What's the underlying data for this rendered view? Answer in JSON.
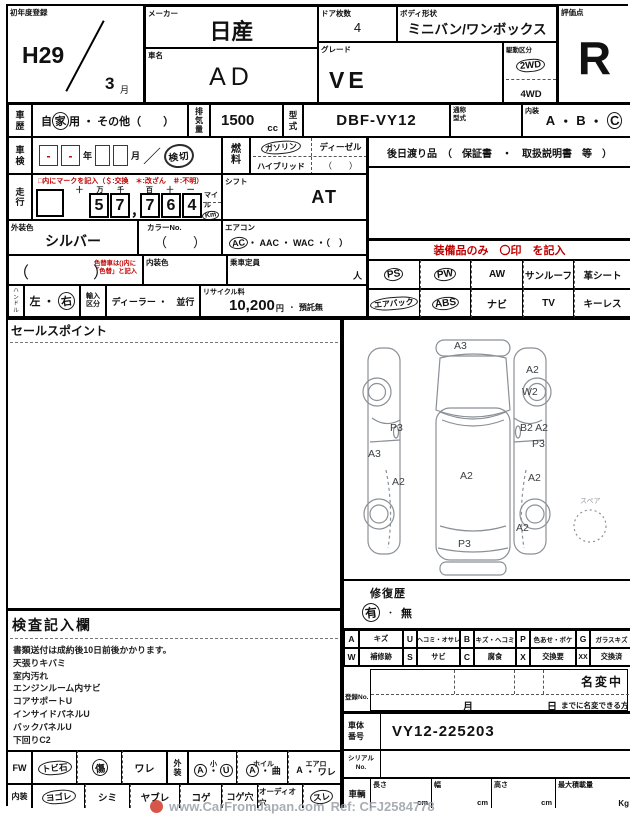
{
  "header": {
    "first_reg": {
      "label": "初年度登録",
      "year": "H29",
      "month": "3",
      "month_unit": "月"
    },
    "maker": {
      "label": "メーカー",
      "value": "日産"
    },
    "car_name": {
      "label": "車名",
      "value": "AD"
    },
    "doors": {
      "label": "ドア枚数",
      "value": "4"
    },
    "body_shape": {
      "label": "ボディ形状",
      "value": "ミニバン/ワンボックス"
    },
    "grade": {
      "label": "グレード",
      "value": "VE"
    },
    "drive": {
      "label": "駆動区分",
      "opt_2wd": "2WD",
      "opt_4wd": "4WD",
      "selected": "2WD"
    },
    "score": {
      "label": "評価点",
      "value": "R"
    }
  },
  "info": {
    "history": {
      "label": "車歴",
      "pre": "自",
      "circled": "家",
      "post": "用",
      "rest": "・ その他（　　）"
    },
    "displacement": {
      "label": "排気量",
      "value": "1500",
      "unit": "cc"
    },
    "model_code": {
      "label": "型式",
      "value": "DBF-VY12"
    },
    "alias": {
      "label": "通称型式"
    },
    "interior_grade": {
      "label": "内装",
      "a": "A",
      "sep1": "・",
      "b": "B",
      "sep2": "・",
      "c": "C",
      "selected": "C"
    },
    "inspection": {
      "label": "車検",
      "dash1": "-",
      "dash2": "-",
      "year_unit": "年",
      "month_unit": "月",
      "slash": "／",
      "stamp": "検切"
    },
    "fuel": {
      "label": "燃料",
      "gasoline": "ガソリン",
      "diesel": "ディーゼル",
      "hybrid": "ハイブリッド",
      "other": "（　　）",
      "selected": "ガソリン"
    },
    "later_goods": {
      "text": "後日渡り品　（　保証書　・　取扱説明書　等　）"
    },
    "mileage": {
      "label": "走行",
      "note": "□内にマークを記入（＄:交換　＊:改ざん　＃:不明）",
      "h1": "十",
      "h2": "万",
      "h3": "千",
      "d1": "5",
      "d2": "7",
      "comma": "，",
      "h4": "百",
      "h5": "十",
      "h6": "一",
      "d3": "7",
      "d4": "6",
      "d5": "4",
      "unit_mile": "マイル",
      "unit_km": "Km",
      "selected_unit": "Km",
      "value": "57,764"
    },
    "shift": {
      "label": "シフト",
      "value": "AT"
    },
    "ext_color": {
      "label": "外装色",
      "value": "シルバー"
    },
    "color_no": {
      "label": "カラーNo.",
      "value": "（　　）"
    },
    "aircon": {
      "label": "エアコン",
      "ac": "AC",
      "rest": "・ AAC ・ WAC ・（　）",
      "selected": "AC"
    },
    "repaint": {
      "paren": "（　　　　）",
      "note1": "色替車は()内に",
      "note2": "「色替」と記入"
    },
    "int_color": {
      "label": "内装色"
    },
    "capacity": {
      "label": "乗車定員",
      "unit": "人"
    },
    "handle": {
      "label": "ハンドル",
      "left": "左",
      "sep": "・",
      "right": "右",
      "selected": "右"
    },
    "import_type": {
      "label": "輸入区分",
      "options": "ディーラー ・　並行"
    },
    "recycle": {
      "label": "リサイクル料",
      "amount": "10,200",
      "yen": "円",
      "sep": "・",
      "status": "預託無"
    }
  },
  "equipment": {
    "note": "装備品のみ　〇印　を記入",
    "r1": [
      "PS",
      "PW",
      "AW",
      "サンルーフ",
      "革シート"
    ],
    "r2": [
      "エアバック",
      "ABS",
      "ナビ",
      "TV",
      "キーレス"
    ],
    "circled": "PS PW エアバック ABS"
  },
  "sales": {
    "title": "セールスポイント"
  },
  "notes": {
    "title": "検査記入欄",
    "lines": [
      "書類送付は成約後10日前後かかります。",
      "天張りキバミ",
      "室内汚れ",
      "エンジンルーム内サビ",
      "コアサポートU",
      "インサイドパネルU",
      "バックパネルU",
      "下回りC2"
    ]
  },
  "glass_row": {
    "label": "FW",
    "opt1": "トビ石",
    "opt2": "傷",
    "opt3": "ワレ",
    "ext_label": "外装",
    "small": {
      "label": "小",
      "a": "A",
      "dot": "・",
      "u": "U"
    },
    "wheel": {
      "label": "ホイル",
      "a": "A",
      "dot": "・",
      "bend": "曲"
    },
    "aero": {
      "label": "エアロ",
      "a": "A",
      "dot": "・",
      "crack": "ワレ"
    }
  },
  "cabin_row": {
    "label": "内装",
    "opts": [
      "ヨゴレ",
      "シミ",
      "ヤブレ",
      "コゲ",
      "コゲ穴",
      "オーディオ穴",
      "スレ"
    ],
    "circled": "ヨゴレ スレ"
  },
  "diagram": {
    "spare": "スペア",
    "labels": [
      "A3",
      "A2",
      "W2",
      "P3",
      "B2 A2",
      "P3",
      "A3",
      "A2",
      "A2",
      "A2",
      "A2",
      "P3"
    ]
  },
  "repair": {
    "label": "修復歴",
    "yes": "有",
    "sep": "・",
    "no": "無",
    "selected": "有"
  },
  "legend": {
    "r1": [
      {
        "k": "A",
        "v": "キズ"
      },
      {
        "k": "U",
        "v": "ヘコミ・オサレ"
      },
      {
        "k": "B",
        "v": "キズ・ヘコミ"
      },
      {
        "k": "P",
        "v": "色あせ・ボケ"
      },
      {
        "k": "G",
        "v": "ガラスキズ"
      }
    ],
    "r2": [
      {
        "k": "W",
        "v": "補修跡"
      },
      {
        "k": "S",
        "v": "サビ"
      },
      {
        "k": "C",
        "v": "腐食"
      },
      {
        "k": "X",
        "v": "交換要"
      },
      {
        "k": "XX",
        "v": "交換済"
      }
    ]
  },
  "registration": {
    "label": "登録No.",
    "pending": "名変中",
    "month": "月",
    "day": "日",
    "note": "までに名変できる方"
  },
  "chassis": {
    "label": "車体番号",
    "value": "VY12-225203"
  },
  "serial": {
    "label": "シリアルNo."
  },
  "dims": {
    "label": "車輌",
    "length": "長さ",
    "width": "幅",
    "height": "高さ",
    "payload": "最大積載量",
    "cm": "cm",
    "kg": "Kg"
  },
  "watermark": {
    "site": "www.CarFromJapan.com",
    "ref": "Ref: CFJ2584778"
  }
}
